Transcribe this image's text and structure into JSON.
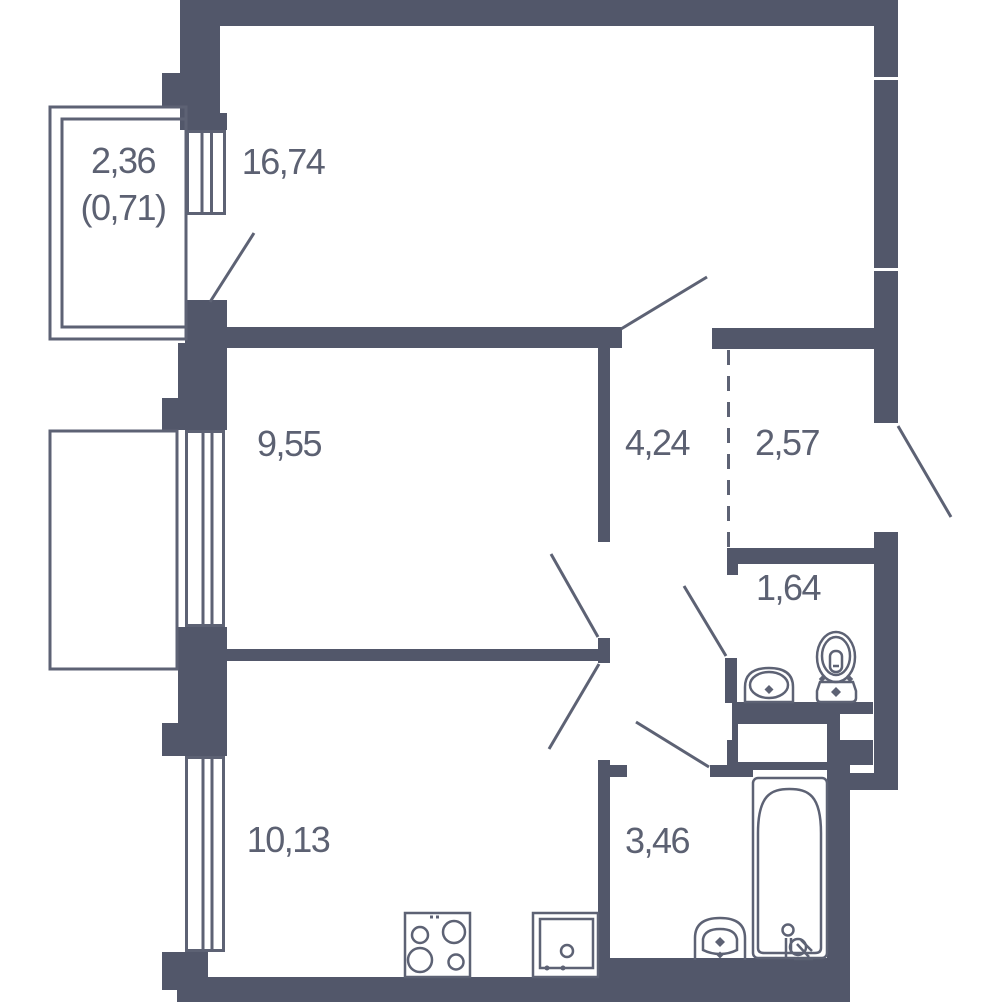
{
  "colors": {
    "wall": "#52576a",
    "line": "#5d6274",
    "text": "#5c6172",
    "background": "#ffffff"
  },
  "rooms": [
    {
      "id": "balcony",
      "area": "2,36",
      "area_secondary": "(0,71)"
    },
    {
      "id": "living-room",
      "area": "16,74"
    },
    {
      "id": "bedroom",
      "area": "9,55"
    },
    {
      "id": "hallway",
      "area": "4,24"
    },
    {
      "id": "entry-hall",
      "area": "2,57"
    },
    {
      "id": "wc",
      "area": "1,64"
    },
    {
      "id": "kitchen",
      "area": "10,13"
    },
    {
      "id": "bathroom",
      "area": "3,46"
    }
  ],
  "fixtures": [
    {
      "name": "stove-icon"
    },
    {
      "name": "kitchen-sink-icon"
    },
    {
      "name": "bathtub-icon"
    },
    {
      "name": "pedestal-sink-icon"
    },
    {
      "name": "vanity-sink-icon"
    },
    {
      "name": "toilet-icon"
    }
  ],
  "symbols": [
    {
      "name": "window-symbol"
    },
    {
      "name": "door-swing-line"
    },
    {
      "name": "dashed-zone-divider"
    },
    {
      "name": "duct-shaft"
    }
  ]
}
